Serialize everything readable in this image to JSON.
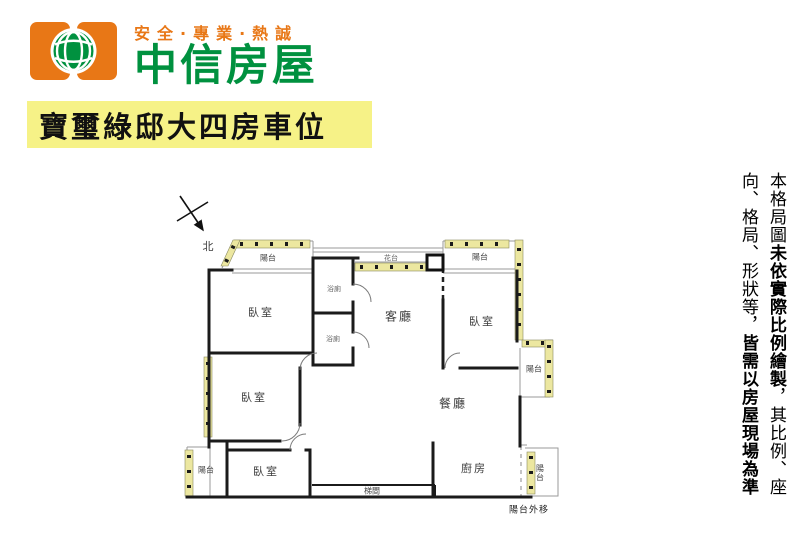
{
  "header": {
    "tagline": "安全·專業·熱誠",
    "brand": "中信房屋"
  },
  "title": "寶璽綠邸大四房車位",
  "floorplan": {
    "north": "北",
    "labels": {
      "balcony_tl": "陽台",
      "bedroom_tl": "臥室",
      "bath_upper": "浴廁",
      "bath_lower": "浴廁",
      "living": "客廳",
      "flower_stand": "花台",
      "balcony_tr": "陽台",
      "bedroom_tr": "臥室",
      "balcony_right": "陽台",
      "dining": "餐廳",
      "bedroom_ml": "臥室",
      "balcony_bl": "陽台",
      "bedroom_bl": "臥室",
      "stairwell": "梯間",
      "kitchen": "廚房",
      "balcony_br": "陽台",
      "balcony_note": "陽台外移"
    }
  },
  "disclaimer": {
    "segments": [
      {
        "text": "本格局圖",
        "bold": false
      },
      {
        "text": "未依實際比例繪製",
        "bold": true
      },
      {
        "text": "，其比例、座向、格局、形狀等，",
        "bold": false
      },
      {
        "text": "皆需以房屋現場為準",
        "bold": true
      }
    ],
    "full_text": "本格局圖未依實際比例繪製，其比例、座向、格局、形狀等，皆需以房屋現場為準"
  },
  "colors": {
    "brand_orange": "#E87716",
    "brand_green": "#00913F",
    "title_bg": "#F6F287",
    "balcony_strip": "#ECE7A0",
    "wall": "#1B1B1B"
  }
}
